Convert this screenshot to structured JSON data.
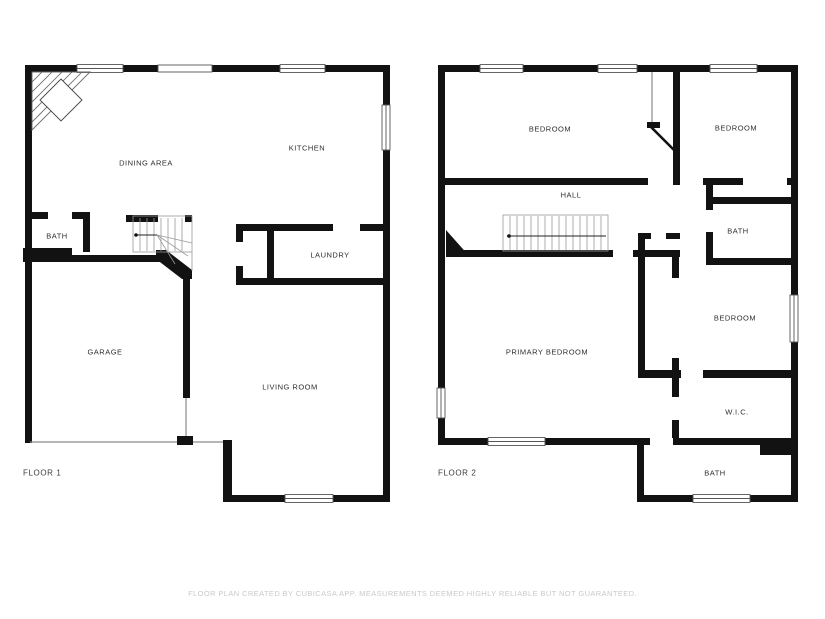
{
  "plan": {
    "title": "Two floor residential floor plan",
    "disclaimer": "FLOOR PLAN CREATED BY CUBICASA APP. MEASUREMENTS DEEMED HIGHLY RELIABLE BUT NOT GUARANTEED.",
    "colors": {
      "background": "#ffffff",
      "walls": "#121212",
      "labels": "#2e2e2e",
      "disclaimer_text": "#c9c9c9",
      "thin_lines": "#8a8a8a"
    },
    "icons": {
      "stairs": "stairs-icon",
      "window": "window-icon",
      "door_opening": "door-opening",
      "door_swing": "door-swing-icon",
      "corner_fireplace": "corner-fireplace-icon",
      "garage_door": "garage-door-opening"
    },
    "floor1": {
      "label": "FLOOR 1",
      "rooms": {
        "dining": "DINING AREA",
        "kitchen": "KITCHEN",
        "bath": "BATH",
        "laundry": "LAUNDRY",
        "garage": "GARAGE",
        "living": "LIVING ROOM"
      }
    },
    "floor2": {
      "label": "FLOOR 2",
      "rooms": {
        "bedroom_a": "BEDROOM",
        "bedroom_b": "BEDROOM",
        "hall": "HALL",
        "bath_upper": "BATH",
        "bedroom_c": "BEDROOM",
        "primary": "PRIMARY BEDROOM",
        "wic": "W.I.C.",
        "bath_lower": "BATH"
      }
    }
  }
}
